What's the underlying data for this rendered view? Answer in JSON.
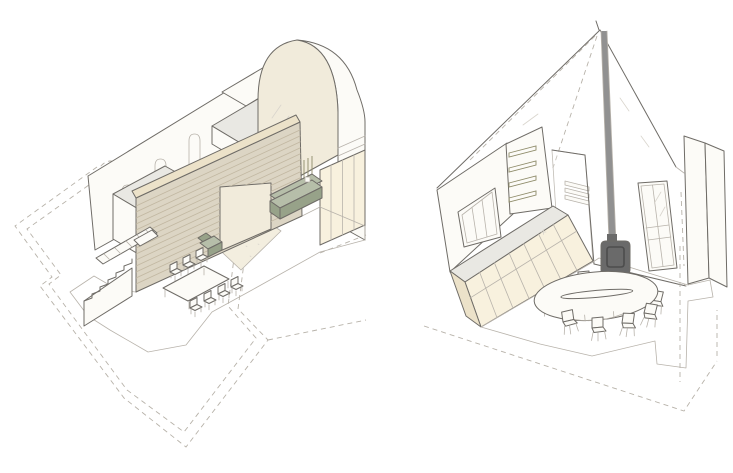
{
  "palette": {
    "background": "#ffffff",
    "line": "#6f6c67",
    "line_light": "#b8b3ab",
    "line_faint": "#d9d5cd",
    "dash": "#b7b2a9",
    "tile": "#edd6bb",
    "tile_light": "#f7ead9",
    "grout": "#c8b5a1",
    "cream": "#f1ebdb",
    "cream_deep": "#f8f1de",
    "cream_dark": "#ece2c9",
    "gray_top": "#e9e8e3",
    "white_warm": "#fcfbf7",
    "wood": "#dcd5c4",
    "wood_grain": "#c2b8a2",
    "rug": "#f3eedf",
    "sage": "#b6bea9",
    "sage_dark": "#97a289",
    "olive": "#c9c590",
    "olive_dark": "#8e8b69",
    "stove": "#6a6a6a",
    "stove_dark": "#4d4d4d",
    "flue": "#919191"
  },
  "left_drawing": {
    "type": "cutaway-axonometric",
    "elements": [
      "plan-outline-dashed",
      "tiled-floor",
      "staircase",
      "stair-railing",
      "back-wall",
      "lancet-windows",
      "dashed-arch",
      "box-volume-left",
      "box-volume-top",
      "white-slab",
      "wood-spine-wall",
      "portal-opening",
      "barrel-vault",
      "vault-side",
      "side-wall-panels",
      "wall-shelves",
      "rug",
      "sofa",
      "armchair",
      "dining-table",
      "dining-chairs"
    ]
  },
  "right_drawing": {
    "type": "interior-perspective",
    "elements": [
      "pitched-roof",
      "hidden-ridge-dashed",
      "flue-pipe",
      "wood-stove",
      "left-wall",
      "three-pane-window",
      "shelf-wall",
      "open-shelves",
      "stair-corridor",
      "corridor-steps",
      "french-door",
      "right-wall",
      "chimney",
      "kitchen-counter",
      "tiled-floor",
      "plan-outline-dashed",
      "oval-dining-table",
      "dining-chairs"
    ]
  }
}
